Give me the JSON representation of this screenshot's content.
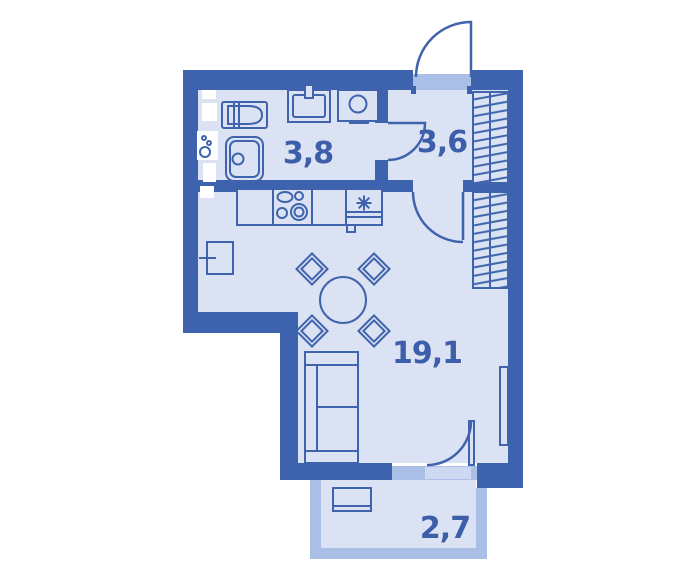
{
  "type": "floor-plan",
  "rooms": {
    "bathroom": {
      "label": "3,8"
    },
    "hallway": {
      "label": "3,6"
    },
    "living": {
      "label": "19,1"
    },
    "balcony": {
      "label": "2,7"
    }
  },
  "fixtures": {
    "bathroom": [
      "bathtub",
      "shower-tray",
      "washbasin",
      "washing-machine",
      "plumbing-shaft"
    ],
    "kitchen": [
      "kitchen-counter",
      "stove",
      "refrigerator",
      "radiator"
    ],
    "living": [
      "dining-table",
      "chair",
      "sofa",
      "wardrobe",
      "radiator"
    ],
    "hallway": [
      "wardrobe",
      "entry-door"
    ],
    "balcony": [
      "balcony-table",
      "balcony-door",
      "window"
    ]
  },
  "colors": {
    "wall": "#3d63ae",
    "line": "#3f63ac",
    "floor": "#dbe2f3",
    "window": "#aabfe5",
    "threshold": "#cdd9f0",
    "shaft": "#ffffff",
    "background": "#ffffff",
    "label_text": "#3d5fa9"
  }
}
